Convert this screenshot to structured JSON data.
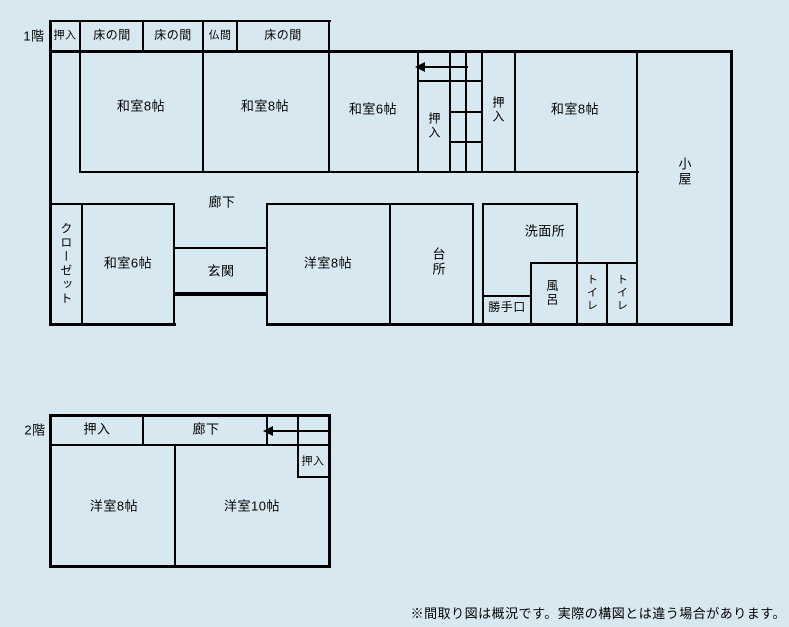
{
  "colors": {
    "background": "#d8e8f1",
    "line": "#000000"
  },
  "floor1": {
    "floor_label": "1階",
    "top_row": {
      "oshiire": "押入",
      "tokonoma_1": "床の間",
      "tokonoma_2": "床の間",
      "butsuma": "仏間",
      "tokonoma_3": "床の間"
    },
    "rooms": {
      "washitsu8_1": "和室8帖",
      "washitsu8_2": "和室8帖",
      "washitsu6_north": "和室6帖",
      "stair_oshiire": "押入",
      "oshiire_north": "押入",
      "washitsu8_3": "和室8帖",
      "koya": "小屋",
      "rouka": "廊下",
      "closet": "クローゼット",
      "washitsu6_south": "和室6帖",
      "genkan": "玄関",
      "youshitsu8": "洋室8帖",
      "daidokoro": "台所",
      "senmenjo": "洗面所",
      "katteguchi": "勝手口",
      "furo": "風呂",
      "toilet_1": "トイレ",
      "toilet_2": "トイレ"
    }
  },
  "floor2": {
    "floor_label": "2階",
    "rooms": {
      "oshiire_top": "押入",
      "rouka": "廊下",
      "oshiire_right": "押入",
      "youshitsu8": "洋室8帖",
      "youshitsu10": "洋室10帖"
    }
  },
  "note": "※間取り図は概況です。実際の構図とは違う場合があります。"
}
